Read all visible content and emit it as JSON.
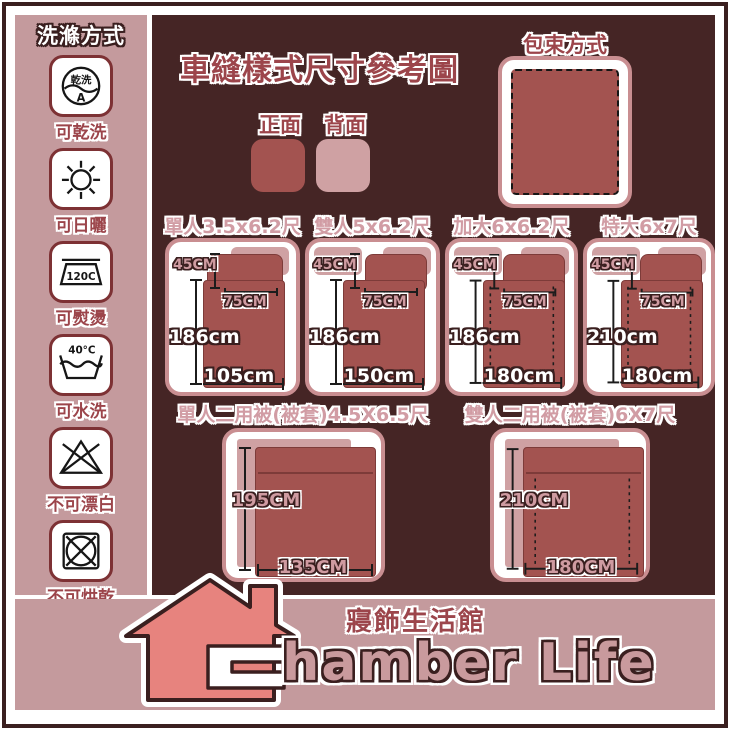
{
  "colors": {
    "background_dark": "#452525",
    "panel_pink": "#c49a9d",
    "card_border_pink": "#c98e91",
    "bed_red": "#a35350",
    "pillow_light_pink": "#cfa1a3",
    "label_dark_red": "#9c454b",
    "label_light_pink": "#d19ca4",
    "house_salmon": "#e7837e",
    "outline_brown": "#3a1f1f"
  },
  "sidebar": {
    "title": "洗滌方式",
    "items": [
      {
        "icon": "dry-clean-icon",
        "icon_text_top": "乾洗",
        "icon_text_bottom": "A",
        "label": "可乾洗"
      },
      {
        "icon": "sun-icon",
        "label": "可日曬"
      },
      {
        "icon": "iron-icon",
        "icon_text": "120C",
        "label": "可熨燙"
      },
      {
        "icon": "hand-wash-icon",
        "icon_text": "40°C",
        "label": "可水洗"
      },
      {
        "icon": "no-bleach-icon",
        "label": "不可漂白"
      },
      {
        "icon": "no-tumble-dry-icon",
        "label": "不可烘乾"
      }
    ]
  },
  "header": {
    "title": "車縫樣式尺寸參考圖",
    "front_label": "正面",
    "back_label": "背面",
    "front_color": "#a35350",
    "back_color": "#cfa1a3"
  },
  "packing": {
    "title": "包束方式"
  },
  "size_cards": [
    {
      "title": "單人3.5x6.2尺",
      "pillow_height": "45CM",
      "pillow_width": "75CM",
      "length": "186cm",
      "width": "105cm"
    },
    {
      "title": "雙人5x6.2尺",
      "pillow_height": "45CM",
      "pillow_width": "75CM",
      "length": "186cm",
      "width": "150cm"
    },
    {
      "title": "加大6x6.2尺",
      "pillow_height": "45CM",
      "pillow_width": "75CM",
      "length": "186cm",
      "width": "180cm"
    },
    {
      "title": "特大6x7尺",
      "pillow_height": "45CM",
      "pillow_width": "75CM",
      "length": "210cm",
      "width": "180cm"
    }
  ],
  "quilt_cards": [
    {
      "title": "單人二用被(被套)4.5X6.5尺",
      "length": "195CM",
      "width": "135CM"
    },
    {
      "title": "雙人二用被(被套)6X7尺",
      "length": "210CM",
      "width": "180CM"
    }
  ],
  "footer": {
    "store_name_zh": "寢飾生活館",
    "store_name_en": "Chamber Life",
    "store_name_en_display": "hamber Life"
  }
}
